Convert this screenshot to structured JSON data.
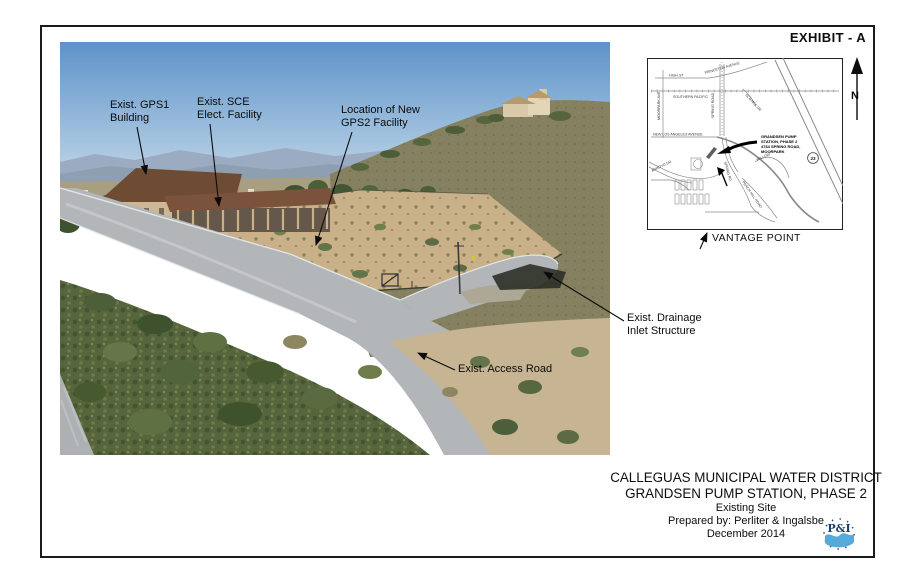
{
  "exhibit": {
    "label": "EXHIBIT - A"
  },
  "photo_annotations": {
    "gps1": {
      "line1": "Exist. GPS1",
      "line2": "Building"
    },
    "sce": {
      "line1": "Exist. SCE",
      "line2": "Elect. Facility"
    },
    "gps2": {
      "line1": "Location of New",
      "line2": "GPS2 Facility"
    },
    "drainage": {
      "line1": "Exist. Drainage",
      "line2": "Inlet Structure"
    },
    "access_road": {
      "label": "Exist. Access Road"
    }
  },
  "map": {
    "streets": {
      "high_st": "HIGH ST",
      "princeton": "PRINCETON AVENUE",
      "southern_pacific": "SOUTHERN PACIFIC",
      "moorpark_ave": "MOORPARK AVE.",
      "new_los_angeles": "NEW LOS ANGELES AVENUE",
      "spring_road": "SPRING ROAD",
      "science_dr": "SCIENCE DR",
      "arroyo_dr": "ARROYO DR",
      "spring_rd": "SPRING RD",
      "peach_hill": "PEACH HILL ROAD",
      "willow": "WILLOW"
    },
    "route_badge": "23",
    "site_label": {
      "line1": "GRANDSEN PUMP",
      "line2": "STATION, PHASE 2",
      "line3": "4764 SPRING ROAD,",
      "line4": "MOORPARK"
    },
    "vantage_point": "VANTAGE POINT"
  },
  "north_arrow": {
    "label": "N"
  },
  "title_block": {
    "district": "CALLEGUAS MUNICIPAL WATER DISTRICT",
    "project": "GRANDSEN PUMP STATION, PHASE 2",
    "subtitle": "Existing Site",
    "prepared_by": "Prepared by: Perliter & Ingalsbe",
    "date": "December 2014"
  },
  "logo": {
    "monogram": "P&I"
  },
  "colors": {
    "sky-top": "#5d93c9",
    "sky-bottom": "#cfe0ec",
    "dirt": "#c9b089",
    "road": "#b3b6b8",
    "brush": "#57653d",
    "hill": "#85805f",
    "logo-wave": "#55aad9",
    "logo-text": "#1c3f6e"
  }
}
